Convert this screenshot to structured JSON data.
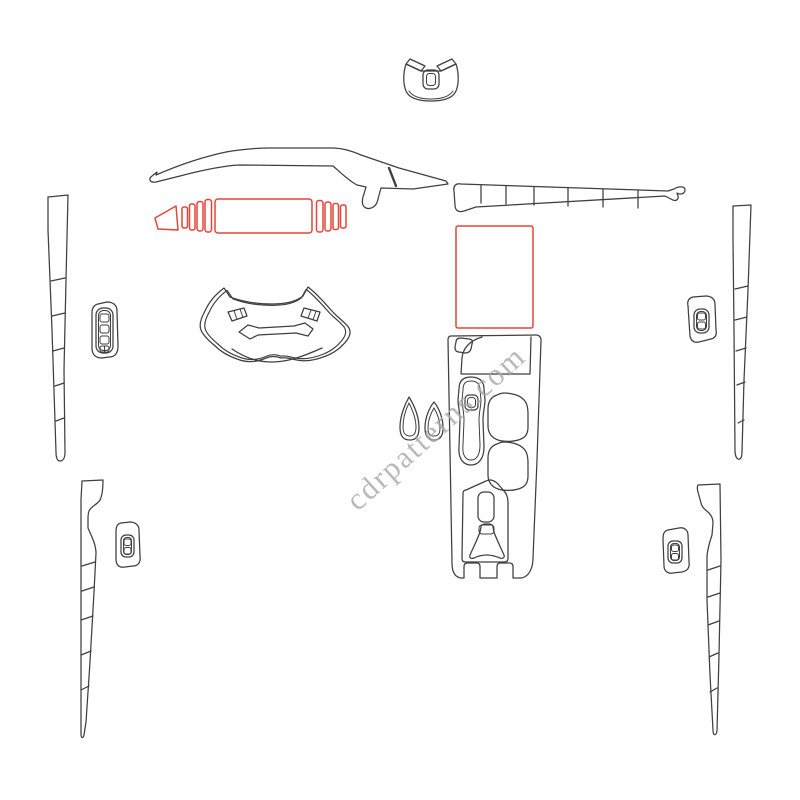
{
  "watermark": {
    "text": "cdrpatterns.com"
  },
  "colors": {
    "background": "#ffffff",
    "outline": "#3f3f3f",
    "highlight": "#e2463a",
    "watermark": "#a8a8a8"
  }
}
